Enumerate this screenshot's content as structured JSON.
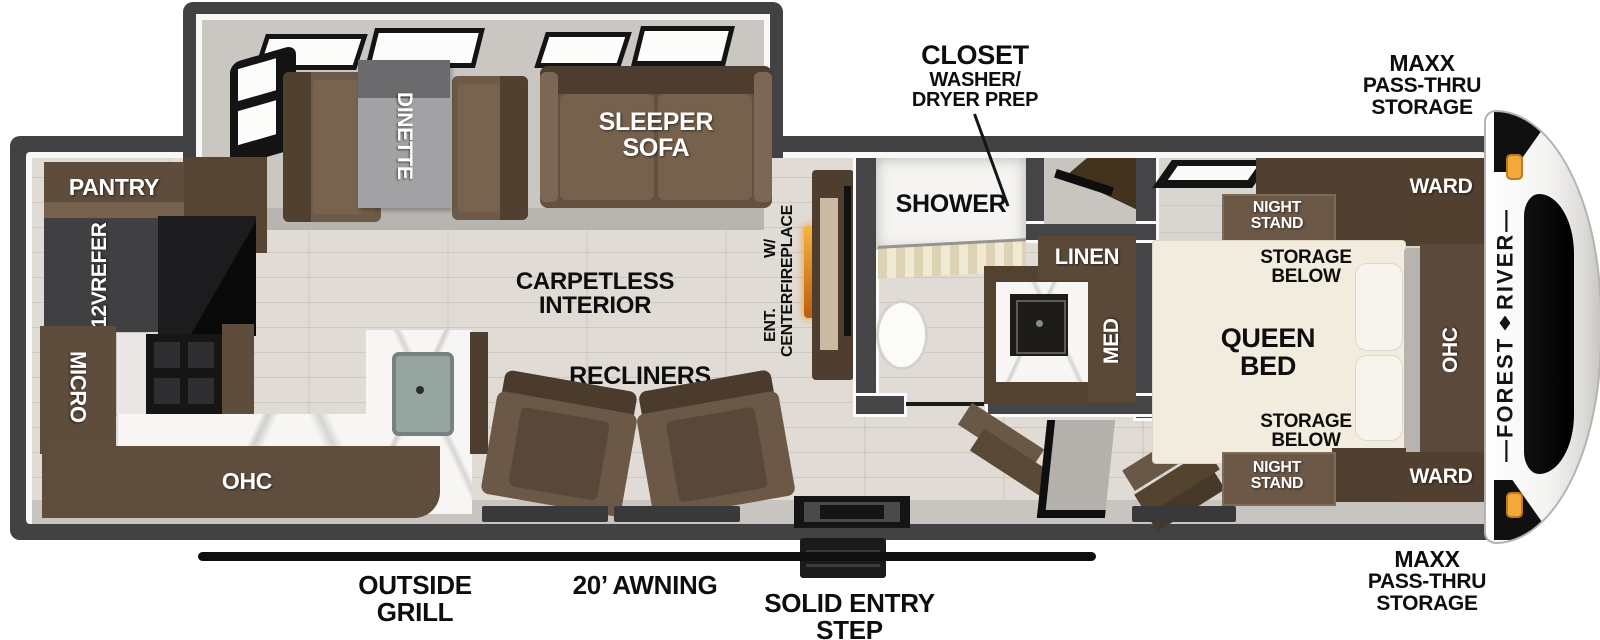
{
  "ext": {
    "closet": [
      "CLOSET",
      "WASHER/",
      "DRYER PREP"
    ],
    "maxx": [
      "MAXX",
      "PASS-THRU",
      "STORAGE"
    ],
    "outside_grill": [
      "OUTSIDE",
      "GRILL"
    ],
    "awning": "20’ AWNING",
    "entry_step": [
      "SOLID ENTRY",
      "STEP"
    ],
    "brand": {
      "line1": "FOREST",
      "line2": "RIVER",
      "dash": "—"
    }
  },
  "living": {
    "carpetless": [
      "CARPETLESS",
      "INTERIOR"
    ],
    "recliners": "RECLINERS",
    "sleeper_sofa": [
      "SLEEPER",
      "SOFA"
    ],
    "dinette": "DINETTE",
    "ent_center": [
      "ENT. CENTER",
      "W/ FIREPLACE"
    ]
  },
  "kitchen": {
    "pantry": "PANTRY",
    "refer": [
      "12V",
      "REFER"
    ],
    "micro": "MICRO",
    "ohc": "OHC"
  },
  "bath": {
    "shower": "SHOWER",
    "linen": "LINEN",
    "med": "MED"
  },
  "bedroom": {
    "queen": [
      "QUEEN",
      "BED"
    ],
    "night_stand": [
      "NIGHT",
      "STAND"
    ],
    "storage_below": [
      "STORAGE",
      "BELOW"
    ],
    "ward": "WARD",
    "ohc": "OHC"
  },
  "colors": {
    "wall": "#424144",
    "amber_light": "#f3a83c",
    "fireplace_glow": "#e8931e",
    "cabinet_brown": "#5f4e3d",
    "sofa_brown": "#6e5a48",
    "bed_cream": "#f2ecdf",
    "floor_wood": "#e0dcd5",
    "awning_black": "#0f0f0f"
  }
}
